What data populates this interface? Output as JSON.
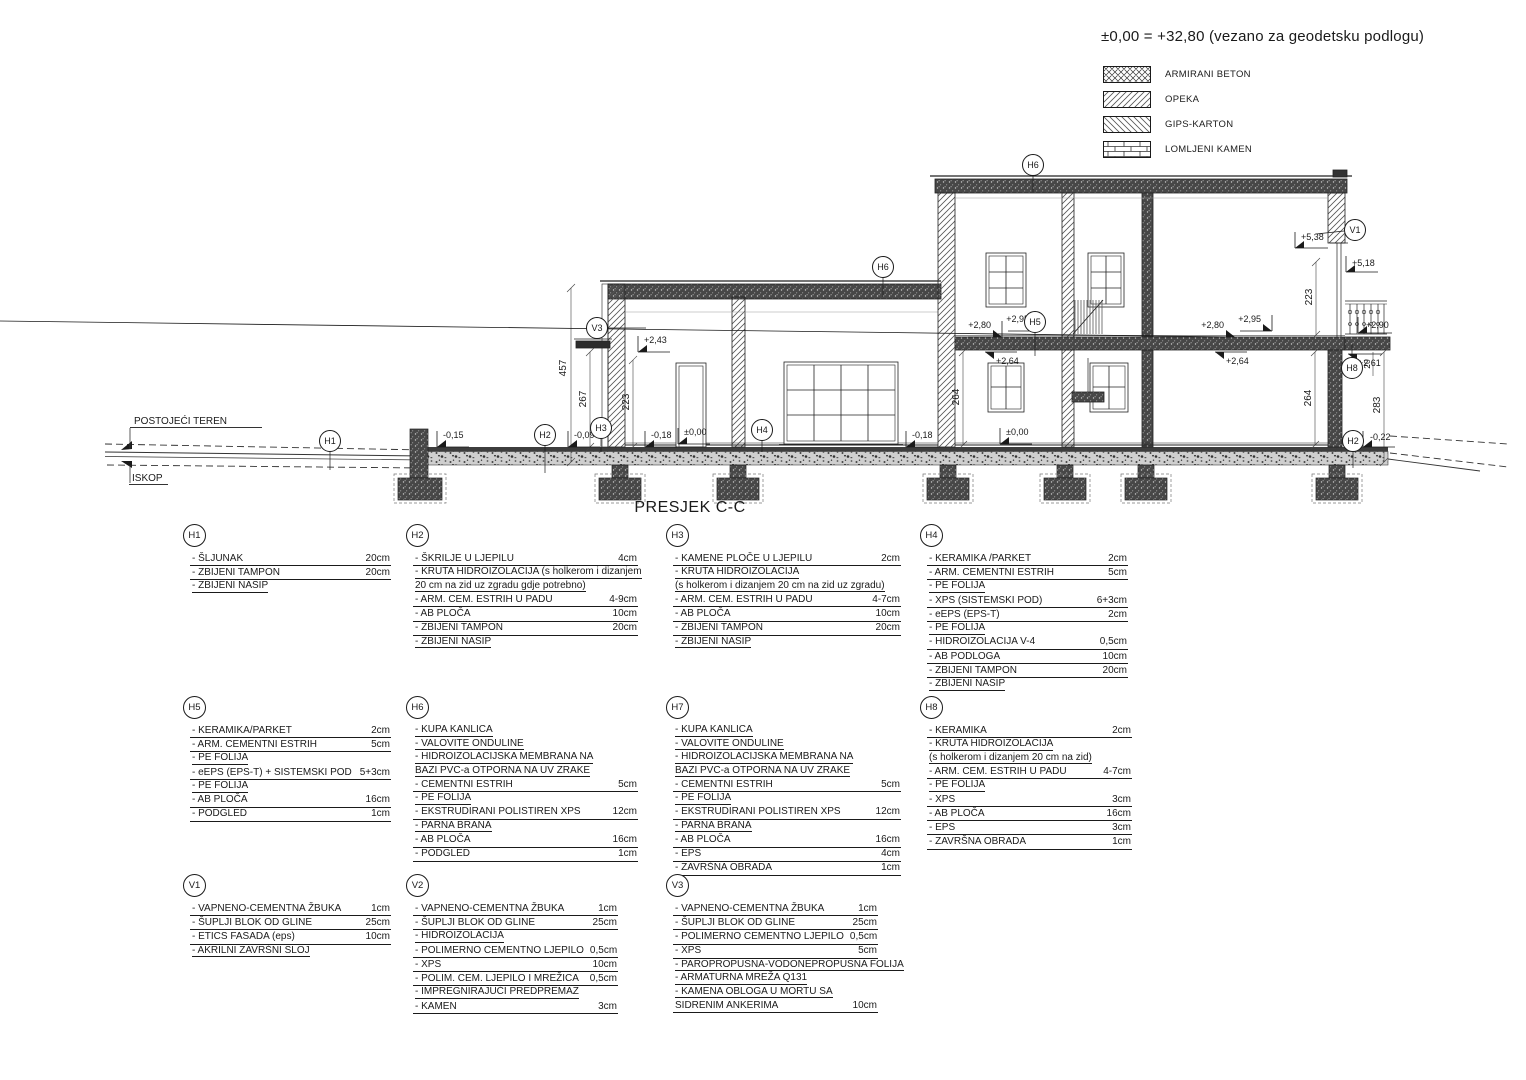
{
  "header": {
    "datum_note": "±0,00 = +32,80 (vezano za geodetsku podlogu)"
  },
  "materials_legend": {
    "items": [
      {
        "name": "ARMIRANI BETON",
        "pattern": "crosshatch"
      },
      {
        "name": "OPEKA",
        "pattern": "diagonal-up"
      },
      {
        "name": "GIPS-KARTON",
        "pattern": "diagonal-down"
      },
      {
        "name": "LOMLJENI KAMEN",
        "pattern": "stone-grid"
      }
    ]
  },
  "drawing": {
    "title": "PRESJEK C-C",
    "terrain": {
      "existing": "POSTOJEĆI TEREN",
      "excavation": "ISKOP"
    },
    "markers": {
      "h1": "H1",
      "h2": "H2",
      "h3": "H3",
      "h4": "H4",
      "h5": "H5",
      "h6": "H6",
      "h7": "H7",
      "h8": "H8",
      "v1": "V1",
      "v2": "V2",
      "v3": "V3"
    },
    "levels": {
      "minus015": "-0,15",
      "minus009": "-0,09",
      "minus018": "-0,18",
      "zero": "±0,00",
      "plus243": "+2,43",
      "plus264": "+2,64",
      "plus280": "+2,80",
      "plus290": "+2,90",
      "plus295": "+2,95",
      "plus261": "+2,61",
      "plus538": "+5,38",
      "plus518": "+5,18",
      "minus022": "-0,22"
    },
    "dims": {
      "d457": "457",
      "d267": "267",
      "d223": "223",
      "d264": "264",
      "d283": "283",
      "d20": "20"
    }
  },
  "layer_tables": [
    {
      "id": "H1",
      "rows": [
        {
          "label": "- ŠLJUNAK",
          "value": "20cm"
        },
        {
          "label": "- ZBIJENI TAMPON",
          "value": "20cm"
        },
        {
          "label": "- ZBIJENI NASIP",
          "value": ""
        }
      ]
    },
    {
      "id": "H2",
      "rows": [
        {
          "label": "- ŠKRILJE U LJEPILU",
          "value": "4cm"
        },
        {
          "label": "- KRUTA HIDROIZOLACIJA  (s holkerom i dizanjem",
          "value": ""
        },
        {
          "label": "  20 cm na zid uz zgradu gdje potrebno)",
          "value": ""
        },
        {
          "label": "- ARM. CEM. ESTRIH U PADU",
          "value": "4-9cm"
        },
        {
          "label": "- AB PLOČA",
          "value": "10cm"
        },
        {
          "label": "- ZBIJENI TAMPON",
          "value": "20cm"
        },
        {
          "label": "- ZBIJENI NASIP",
          "value": ""
        }
      ]
    },
    {
      "id": "H3",
      "rows": [
        {
          "label": "- KAMENE PLOČE U LJEPILU",
          "value": "2cm"
        },
        {
          "label": "- KRUTA HIDROIZOLACIJA",
          "value": ""
        },
        {
          "label": "(s holkerom i dizanjem 20 cm na zid uz zgradu)",
          "value": ""
        },
        {
          "label": "- ARM. CEM. ESTRIH U PADU",
          "value": "4-7cm"
        },
        {
          "label": "- AB PLOČA",
          "value": "10cm"
        },
        {
          "label": "- ZBIJENI TAMPON",
          "value": "20cm"
        },
        {
          "label": "- ZBIJENI NASIP",
          "value": ""
        }
      ]
    },
    {
      "id": "H4",
      "rows": [
        {
          "label": "- KERAMIKA /PARKET",
          "value": "2cm"
        },
        {
          "label": "- ARM. CEMENTNI ESTRIH",
          "value": "5cm"
        },
        {
          "label": "- PE FOLIJA",
          "value": ""
        },
        {
          "label": "- XPS (SISTEMSKI POD)",
          "value": "6+3cm"
        },
        {
          "label": "- eEPS (EPS-T)",
          "value": "2cm"
        },
        {
          "label": "- PE FOLIJA",
          "value": ""
        },
        {
          "label": "- HIDROIZOLACIJA V-4",
          "value": "0,5cm"
        },
        {
          "label": "- AB PODLOGA",
          "value": "10cm"
        },
        {
          "label": "- ZBIJENI TAMPON",
          "value": "20cm"
        },
        {
          "label": "- ZBIJENI NASIP",
          "value": ""
        }
      ]
    },
    {
      "id": "H5",
      "rows": [
        {
          "label": "- KERAMIKA/PARKET",
          "value": "2cm"
        },
        {
          "label": "- ARM. CEMENTNI ESTRIH",
          "value": "5cm"
        },
        {
          "label": "- PE FOLIJA",
          "value": ""
        },
        {
          "label": "- eEPS (EPS-T) + SISTEMSKI POD",
          "value": "5+3cm"
        },
        {
          "label": "- PE FOLIJA",
          "value": ""
        },
        {
          "label": "- AB PLOČA",
          "value": "16cm"
        },
        {
          "label": "- PODGLED",
          "value": "1cm"
        }
      ]
    },
    {
      "id": "H6",
      "rows": [
        {
          "label": "- KUPA KANLICA",
          "value": ""
        },
        {
          "label": "- VALOVITE ONDULINE",
          "value": ""
        },
        {
          "label": "- HIDROIZOLACIJSKA MEMBRANA NA",
          "value": ""
        },
        {
          "label": "  BAZI PVC-a  OTPORNA NA UV ZRAKE",
          "value": ""
        },
        {
          "label": "- CEMENTNI ESTRIH",
          "value": "5cm"
        },
        {
          "label": "- PE FOLIJA",
          "value": ""
        },
        {
          "label": "- EKSTRUDIRANI POLISTIREN XPS",
          "value": "12cm"
        },
        {
          "label": "- PARNA BRANA",
          "value": ""
        },
        {
          "label": "- AB PLOČA",
          "value": "16cm"
        },
        {
          "label": "- PODGLED",
          "value": "1cm"
        }
      ]
    },
    {
      "id": "H7",
      "rows": [
        {
          "label": "- KUPA KANLICA",
          "value": ""
        },
        {
          "label": "- VALOVITE ONDULINE",
          "value": ""
        },
        {
          "label": "- HIDROIZOLACIJSKA MEMBRANA NA",
          "value": ""
        },
        {
          "label": "  BAZI PVC-a  OTPORNA NA UV ZRAKE",
          "value": ""
        },
        {
          "label": "- CEMENTNI ESTRIH",
          "value": "5cm"
        },
        {
          "label": "- PE FOLIJA",
          "value": ""
        },
        {
          "label": "- EKSTRUDIRANI POLISTIREN XPS",
          "value": "12cm"
        },
        {
          "label": "- PARNA BRANA",
          "value": ""
        },
        {
          "label": "- AB PLOČA",
          "value": "16cm"
        },
        {
          "label": "- EPS",
          "value": "4cm"
        },
        {
          "label": "- ZAVRŠNA OBRADA",
          "value": "1cm"
        }
      ]
    },
    {
      "id": "H8",
      "rows": [
        {
          "label": "- KERAMIKA",
          "value": "2cm"
        },
        {
          "label": "- KRUTA HIDROIZOLACIJA",
          "value": ""
        },
        {
          "label": "  (s holkerom i dizanjem 20 cm na zid)",
          "value": ""
        },
        {
          "label": "- ARM. CEM. ESTRIH U PADU",
          "value": "4-7cm"
        },
        {
          "label": "- PE FOLIJA",
          "value": ""
        },
        {
          "label": "- XPS",
          "value": "3cm"
        },
        {
          "label": "- AB PLOČA",
          "value": "16cm"
        },
        {
          "label": "- EPS",
          "value": "3cm"
        },
        {
          "label": "- ZAVRŠNA OBRADA",
          "value": "1cm"
        }
      ]
    },
    {
      "id": "V1",
      "rows": [
        {
          "label": "- VAPNENO-CEMENTNA ŽBUKA",
          "value": "1cm"
        },
        {
          "label": "- ŠUPLJI BLOK OD GLINE",
          "value": "25cm"
        },
        {
          "label": "- ETICS FASADA (eps)",
          "value": "10cm"
        },
        {
          "label": "- AKRILNI ZAVRŠNI SLOJ",
          "value": ""
        }
      ]
    },
    {
      "id": "V2",
      "rows": [
        {
          "label": "- VAPNENO-CEMENTNA ŽBUKA",
          "value": "1cm"
        },
        {
          "label": "- ŠUPLJI BLOK OD GLINE",
          "value": "25cm"
        },
        {
          "label": "- HIDROIZOLACIJA",
          "value": ""
        },
        {
          "label": "- POLIMERNO CEMENTNO LJEPILO",
          "value": "0,5cm"
        },
        {
          "label": "- XPS",
          "value": "10cm"
        },
        {
          "label": "- POLIM. CEM. LJEPILO I MREŽICA",
          "value": "0,5cm"
        },
        {
          "label": "- IMPREGNIRAJUĆI PREDPREMAZ",
          "value": ""
        },
        {
          "label": "- KAMEN",
          "value": "3cm"
        }
      ]
    },
    {
      "id": "V3",
      "rows": [
        {
          "label": "- VAPNENO-CEMENTNA ŽBUKA",
          "value": "1cm"
        },
        {
          "label": "- ŠUPLJI BLOK OD GLINE",
          "value": "25cm"
        },
        {
          "label": "- POLIMERNO CEMENTNO LJEPILO",
          "value": "0,5cm"
        },
        {
          "label": "- XPS",
          "value": "5cm"
        },
        {
          "label": "- PAROPROPUSNA-VODONEPROPUSNA FOLIJA",
          "value": ""
        },
        {
          "label": "- ARMATURNA MREŽA Q131",
          "value": ""
        },
        {
          "label": "- KAMENA OBLOGA U MORTU SA",
          "value": ""
        },
        {
          "label": "SIDRENIM ANKERIMA",
          "value": "10cm"
        }
      ]
    }
  ]
}
